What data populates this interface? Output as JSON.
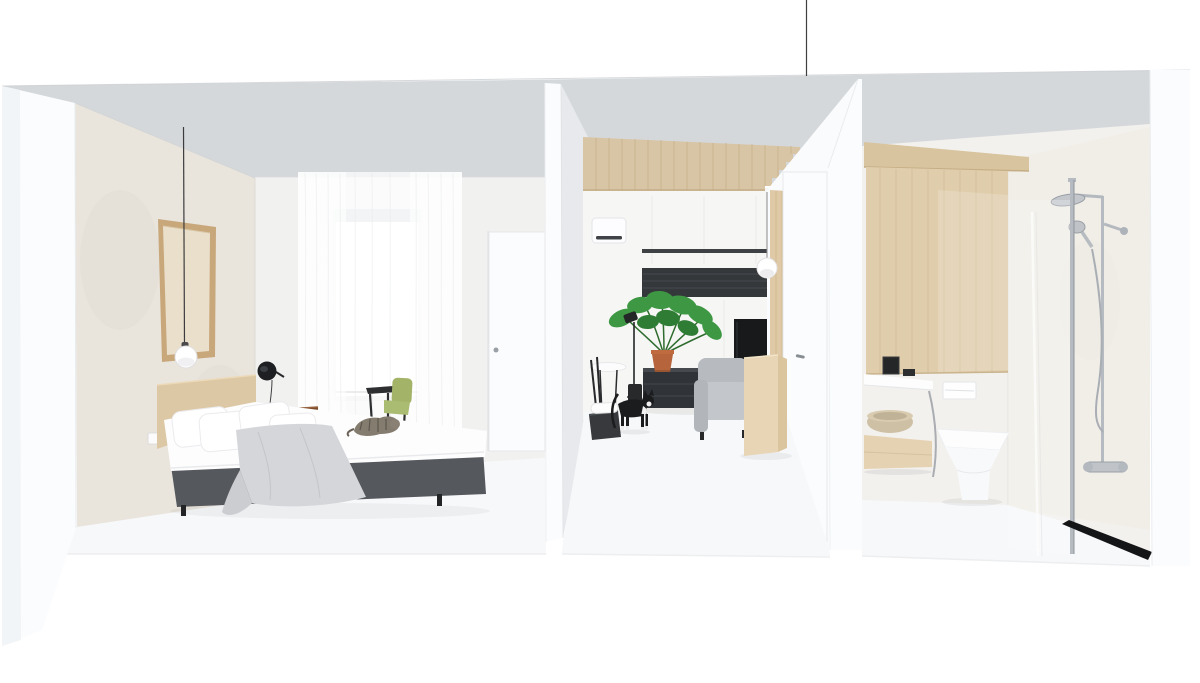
{
  "scene": {
    "type": "3d-interior-render",
    "rooms": [
      "bedroom",
      "living-room",
      "bathroom"
    ],
    "view": "cutaway-dollhouse-front"
  },
  "palette": {
    "bg_white": "#ffffff",
    "ceiling": "#d5d8db",
    "cut_slab_white": "#fbfcfd",
    "divider_side": "#e7e9ec",
    "bedroom_accent_wall": "#e9e4dc",
    "bedroom_back_wall": "#f1f1f0",
    "living_back_wall": "#f6f6f5",
    "bath_wall": "#f3f1ee",
    "shower_wall": "#f1eee7",
    "floor_white": "#f7f8fa",
    "wood_ceiling": "#d8c5a5",
    "wood_panel": "#dfc9a6",
    "valance_wood": "#d8c49f",
    "sliding_door_wood": "#e0cdac",
    "headboard_wood": "#ddc8a5",
    "frame_wood": "#c8a77b",
    "frame_canvas": "#eadfcb",
    "nightstand_brown": "#7c4a2c",
    "bed_base_gray": "#55585d",
    "mattress_white": "#fdfdfe",
    "blanket_gray": "#d4d6d9",
    "curtain_white": "#ffffff",
    "chair_green": "#a3b469",
    "chair_frame": "#2e2f31",
    "dark_band": "#35383b",
    "tv_black": "#17191a",
    "sideboard_dark": "#303337",
    "sofa_gray": "#c3c6cb",
    "cabinet_wood": "#e8d5b5",
    "plant_green": "#3e9743",
    "plant_green_dark": "#2f7c35",
    "pot_terracotta": "#b5643c",
    "bowl_tan": "#cdc0a4",
    "drawer_wood": "#e5d2b2",
    "chrome": "#b6bbc1",
    "drain_black": "#141517",
    "cat_black": "#1b1c1e",
    "cat_tabby": "#857c70",
    "pendant_globe": "#ffffff",
    "door_white": "#fbfcfd"
  }
}
